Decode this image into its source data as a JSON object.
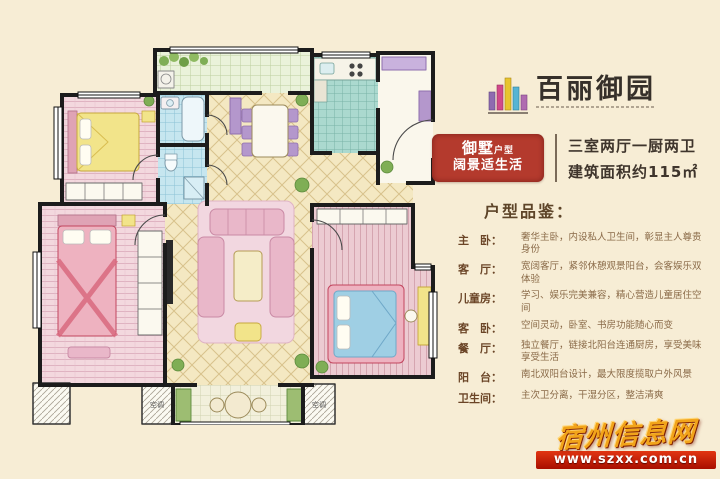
{
  "colors": {
    "background": "#f7edd5",
    "badge_red": "#b43a2d",
    "watermark_gold": "#f2a41a",
    "watermark_bar_red": "#b81200",
    "wall_black": "#1c1c1c"
  },
  "header": {
    "logo_text": "百丽御园",
    "badge": {
      "title_main": "御墅",
      "title_sub": "户型",
      "subtitle": "阔景适生活"
    },
    "specs_line1": "三室两厅一厨两卫",
    "specs_line2": "建筑面积约115㎡"
  },
  "details": {
    "section_title": "户型品鉴：",
    "items": [
      {
        "label": "主　卧：",
        "desc": "奢华主卧，内设私人卫生间，彰显主人尊贵身份"
      },
      {
        "label": "客　厅：",
        "desc": "宽阔客厅，紧邻休憩观景阳台，会客娱乐双体验"
      },
      {
        "label": "儿童房：",
        "desc": "学习、娱乐完美兼容，精心营造儿童居住空间"
      },
      {
        "label": "客　卧：",
        "desc": "空间灵动，卧室、书房功能随心而变"
      },
      {
        "label": "餐　厅：",
        "desc": "独立餐厅，链接北阳台连通厨房，享受美味享受生活"
      },
      {
        "label": "阳　台：",
        "desc": "南北双阳台设计，最大限度揽取户外风景"
      },
      {
        "label": "卫生间：",
        "desc": "主次卫分离，干湿分区，整洁清爽"
      }
    ]
  },
  "floorplan": {
    "ac_label": "空调"
  },
  "watermark": {
    "site_name": "宿州信息网",
    "site_url": "www.szxx.com.cn"
  }
}
